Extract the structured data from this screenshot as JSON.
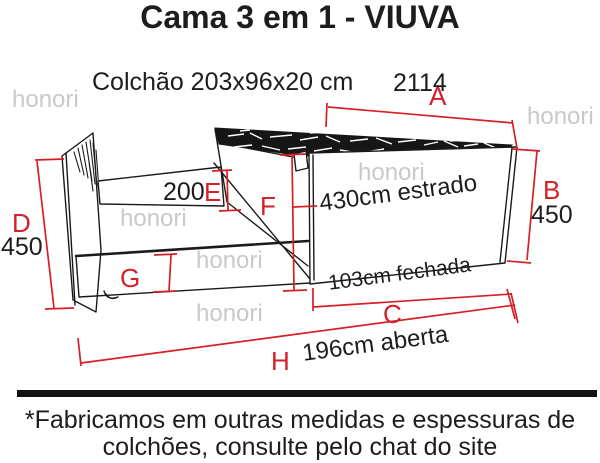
{
  "title": "Cama 3 em 1 - VIUVA",
  "watermark": "honori",
  "diagram": {
    "mattress_spec": "Colchão 203x96x20 cm",
    "dim_a_value": "2114",
    "dim_b_value": "450",
    "dim_d_value": "450",
    "dim_e_value": "200",
    "dim_labels": {
      "a": "A",
      "b": "B",
      "c": "C",
      "d": "D",
      "e": "E",
      "f": "F",
      "g": "G",
      "h": "H"
    },
    "slat_note": "430cm estrado",
    "closed_note": "103cm fechada",
    "open_note": "196cm aberta"
  },
  "footer": {
    "line1": "*Fabricamos em outras medidas e espessuras de",
    "line2": "colchões, consulte pelo chat do site"
  },
  "colors": {
    "dimension_red": "#d61f26",
    "watermark_gray": "#c9c9c9",
    "line_black": "#1a1a1a"
  }
}
